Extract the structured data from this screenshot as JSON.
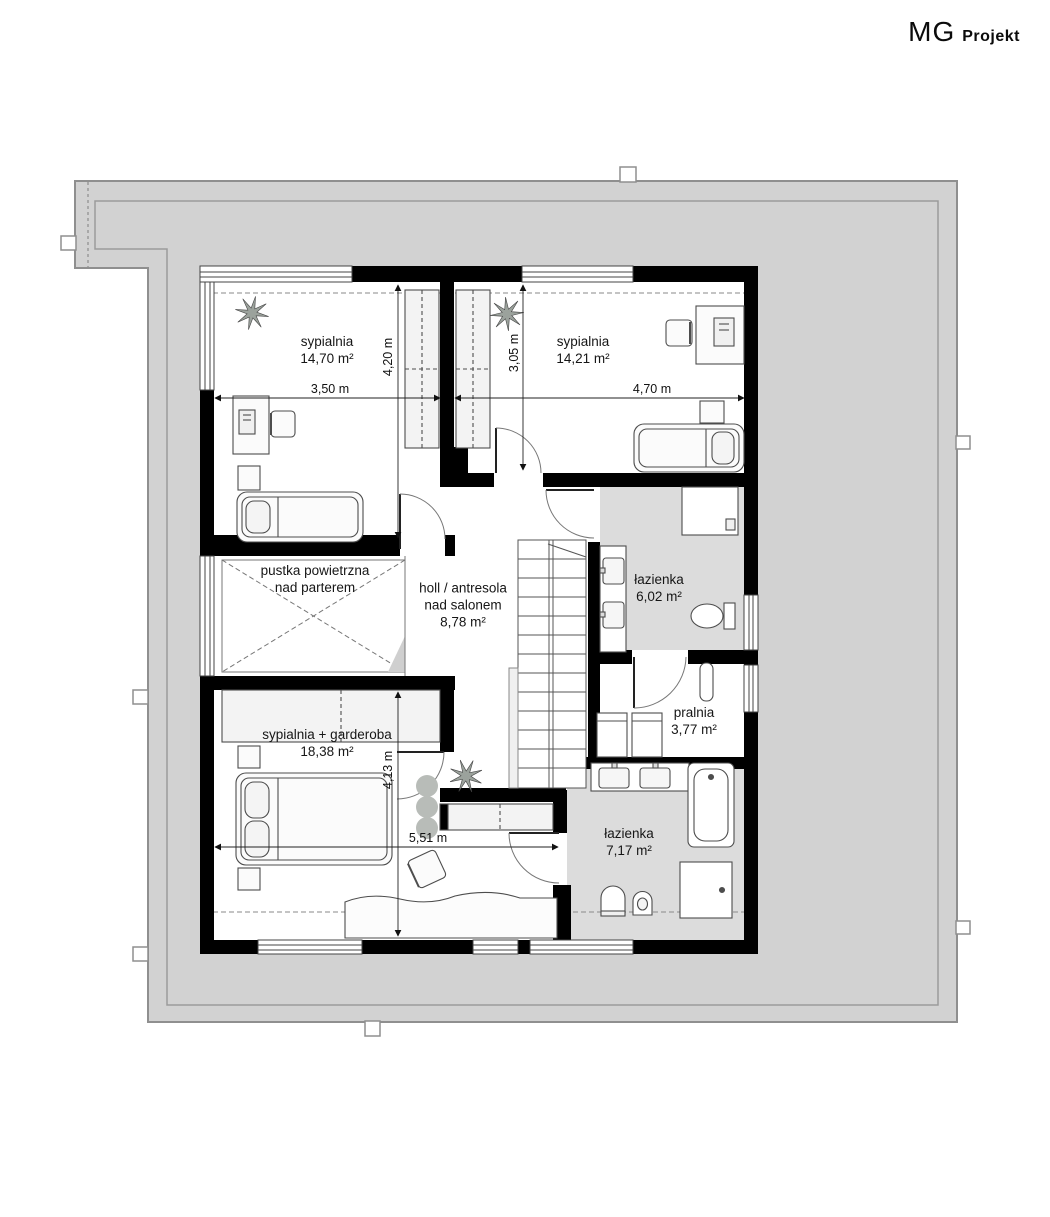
{
  "logo": {
    "mg": "MG",
    "projekt": "Projekt"
  },
  "rooms": [
    {
      "name": "sypialnia",
      "area": "14,70 m²"
    },
    {
      "name": "sypialnia",
      "area": "14,21 m²"
    },
    {
      "name": "pustka powietrzna",
      "name2": "nad parterem"
    },
    {
      "name": "holl / antresola",
      "name2": "nad salonem",
      "area": "8,78 m²"
    },
    {
      "name": "łazienka",
      "area": "6,02 m²"
    },
    {
      "name": "pralnia",
      "area": "3,77 m²"
    },
    {
      "name": "sypialnia + garderoba",
      "area": "18,38 m²"
    },
    {
      "name": "łazienka",
      "area": "7,17 m²"
    }
  ],
  "dimensions": {
    "bedroom_left_width": "3,50 m",
    "bedroom_left_height": "4,20 m",
    "bedroom_right_height": "3,05 m",
    "bedroom_right_width": "4,70 m",
    "bedroom_master_height": "4,13 m",
    "bedroom_master_width": "5,51 m"
  },
  "colors": {
    "roof": "#d2d2d2",
    "roof_line": "#8f8f8f",
    "wall": "#000000",
    "bathroom_floor": "#dcdcdc",
    "furniture_stroke": "#4d4d4d"
  }
}
